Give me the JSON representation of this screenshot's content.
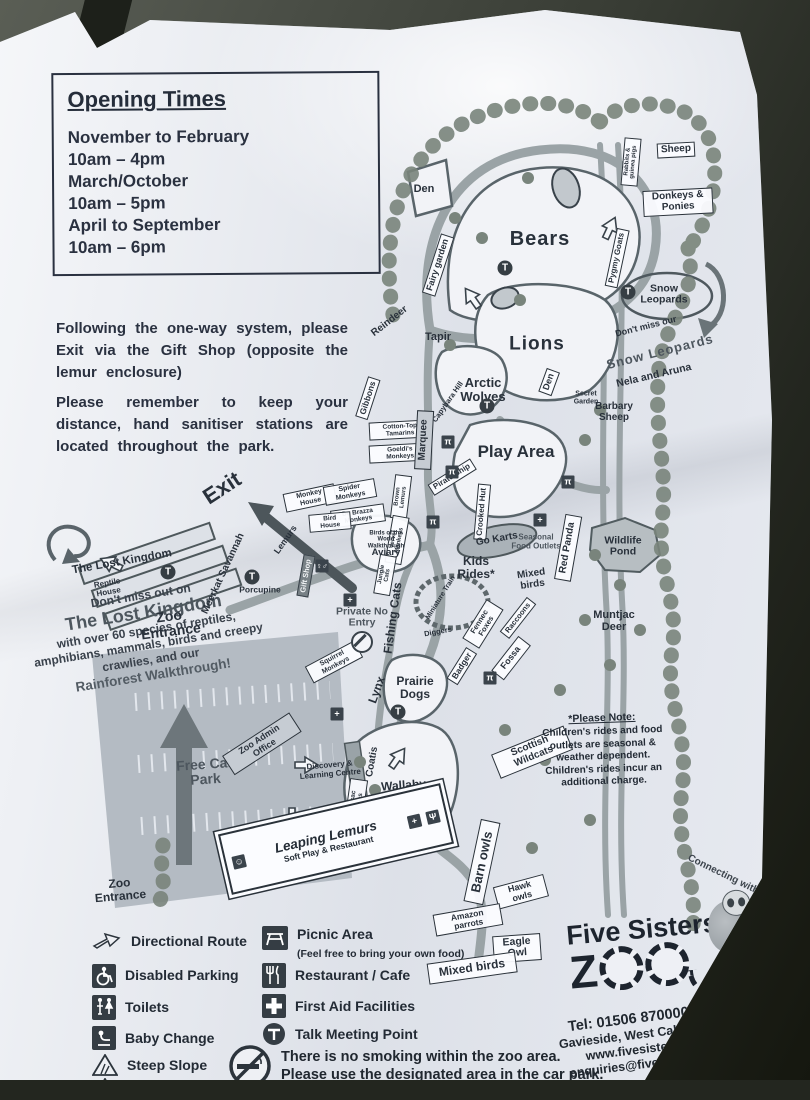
{
  "info_panel": {
    "opening_times": {
      "title": "Opening Times",
      "lines": [
        "November to February",
        "10am – 4pm",
        "March/October",
        "10am – 5pm",
        "April to September",
        "10am – 6pm"
      ]
    },
    "paragraph1": "Following the one-way system, please Exit via the Gift Shop (opposite the lemur enclosure)",
    "paragraph2": "Please remember to keep your distance, hand sanitiser stations are located throughout the park."
  },
  "promo": {
    "intro": "Don't miss out on",
    "title": "The Lost Kingdom",
    "body": "with over 60 species of reptiles, amphibians, mammals, birds and creepy crawlies, and our",
    "highlight": "Rainforest Walkthrough!"
  },
  "map": {
    "labels": {
      "den_top": "Den",
      "bears": "Bears",
      "fairy_garden": "Fairy garden",
      "rabbits_guinea_pigs": "Rabbits & guinea pigs",
      "sheep": "Sheep",
      "donkeys_ponies": "Donkeys & Ponies",
      "pygmy_goats": "Pygmy Goats",
      "snow_leopards_oval": "Snow Leopards",
      "dont_miss_our": "Don't miss our",
      "snow_leopards_title": "Snow Leopards",
      "snow_leopards_names": "Nela and Aruna",
      "barbary_sheep": "Barbary Sheep",
      "reindeer": "Reindeer",
      "tapir": "Tapir",
      "lions": "Lions",
      "den_lions": "Den",
      "arctic_wolves": "Arctic Wolves",
      "secret_garden": "Secret Garden",
      "gibbons": "Gibbons",
      "cotton_top_tamarins": "Cotton-Top Tamarins",
      "goeldis_monkeys": "Goeldi's Monkeys",
      "capybara_hill": "Capybara Hill",
      "marquee": "Marquee",
      "play_area": "Play Area",
      "pirate_ship": "Pirate Ship",
      "crooked_hut": "Crooked Hut",
      "go_karts": "Go Karts",
      "kids_rides": "Kids Rides*",
      "seasonal_food_outlets": "Seasonal Food Outlets",
      "red_panda": "Red Panda",
      "wildlife_pond": "Wildlife Pond",
      "mixed_birds_mid": "Mixed birds",
      "muntjac_deer": "Muntjac Deer",
      "miniature_train": "Miniature Train",
      "diggers": "Diggers",
      "fennec_foxes": "Fennec Foxes",
      "raccoons": "Raccoons",
      "badger": "Badger",
      "fossa": "Fossa",
      "fishing_cats": "Fishing Cats",
      "brown_lemurs": "Brown Lemurs",
      "vervet_monkeys": "Vervet Monkeys",
      "jungle_cats": "Jungle Cats",
      "exit": "Exit",
      "the_lost_kingdom": "The Lost Kingdom",
      "reptile_house": "Reptile House",
      "meerkat_savannah": "Meerkat Savannah",
      "zoo_entrance_top": "Zoo Entrance",
      "porcupine": "Porcupine",
      "lemurs": "Lemurs",
      "monkey_house": "Monkey House",
      "spider_monkeys": "Spider Monkeys",
      "de_brazza_monkeys": "De Brazza Monkeys",
      "bird_house": "Bird House",
      "aviary_sub": "Birds of the World Walkthrough",
      "aviary": "Aviary",
      "gift_shop": "Gift Shop",
      "private_no_entry": "Private No Entry",
      "squirrel_monkeys": "Squirrel Monkeys",
      "free_car_park": "Free Car Park",
      "zoo_admin_office": "Zoo Admin Office",
      "discovery_centre": "Discovery & Learning Centre",
      "coatis": "Coatis",
      "corsac_foxes": "Corsac Foxes",
      "lynx": "Lynx",
      "prairie_dogs": "Prairie Dogs",
      "wallaby_walkthrough": "Wallaby Walkthrough",
      "scottish_wildcats": "Scottish Wildcats",
      "leaping_lemurs": "Leaping Lemurs",
      "leaping_lemurs_sub": "Soft Play & Restaurant",
      "zoo_entrance_bottom": "Zoo Entrance",
      "barn_owls": "Barn owls",
      "hawk_owls": "Hawk owls",
      "amazon_parrots": "Amazon parrots",
      "eagle_owl": "Eagle Owl",
      "mixed_birds_bottom": "Mixed birds",
      "t_letter": "T"
    }
  },
  "please_note": {
    "title": "*Please Note:",
    "body": "Children's rides and food outlets are seasonal & weather dependent. Children's rides incur an additional charge."
  },
  "legend_left": [
    {
      "icon": "directional-route",
      "label": "Directional Route"
    },
    {
      "icon": "disabled-parking",
      "label": "Disabled Parking"
    },
    {
      "icon": "toilets",
      "label": "Toilets"
    },
    {
      "icon": "baby-change",
      "label": "Baby Change"
    },
    {
      "icon": "steep-slope",
      "label": "Steep Slope"
    },
    {
      "icon": "enclosure-closed",
      "label": "Enclosure currently"
    }
  ],
  "legend_mid": [
    {
      "icon": "picnic-area",
      "label": "Picnic Area",
      "sub": "(Feel free to bring your own food)"
    },
    {
      "icon": "restaurant",
      "label": "Restaurant / Cafe"
    },
    {
      "icon": "first-aid",
      "label": "First Aid Facilities"
    },
    {
      "icon": "talk-point",
      "label": "Talk Meeting Point"
    }
  ],
  "no_smoking": {
    "line1": "There is no smoking within the zoo area.",
    "line2": "Please use the designated area in the car park."
  },
  "brand": {
    "name_top": "Five Sisters",
    "z": "Z",
    "tagline": "Connecting with Wildlife",
    "since": "Since 2005"
  },
  "contact": {
    "tel": "Tel: 01506 870000 / 871111",
    "address": "Gavieside, West Calder, EH55 8PT",
    "web": "www.fivesisterszoo.co.uk",
    "email": "enquiries@fivesisterszoo.co.uk"
  }
}
